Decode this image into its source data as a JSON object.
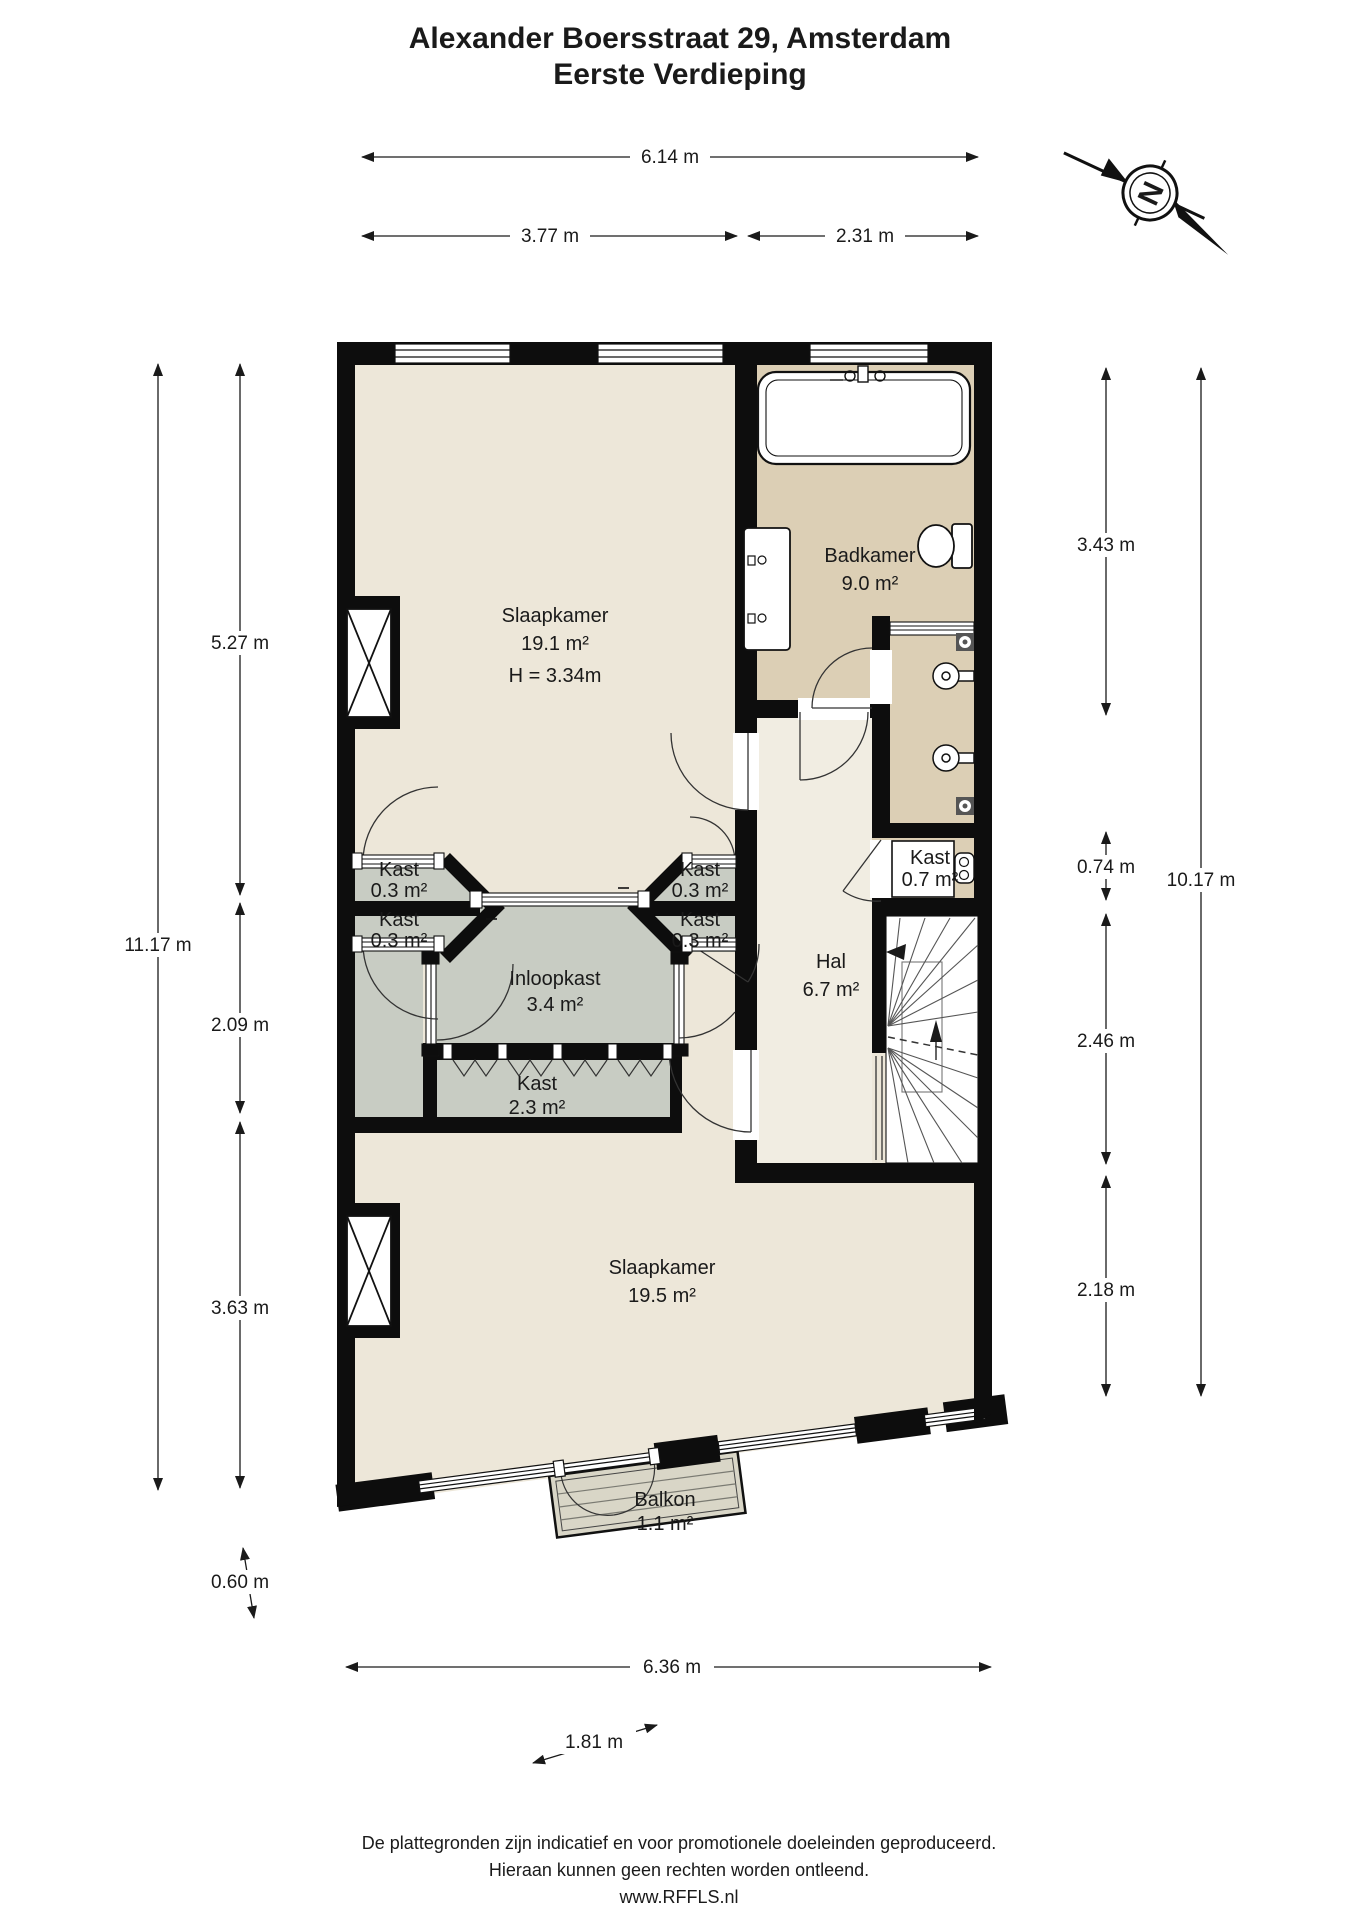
{
  "title": {
    "line1": "Alexander Boersstraat 29, Amsterdam",
    "line2": "Eerste Verdieping"
  },
  "compass": {
    "north": "N"
  },
  "dimensions": {
    "top_total": "6.14 m",
    "top_left": "3.77 m",
    "top_right": "2.31 m",
    "left_total": "11.17 m",
    "left_top": "5.27 m",
    "left_mid": "2.09 m",
    "left_bottom": "3.63 m",
    "balcony_depth": "0.60 m",
    "right_bath": "3.43 m",
    "right_kast": "0.74 m",
    "right_stairs": "2.46 m",
    "right_bed": "2.18 m",
    "right_total": "10.17 m",
    "bottom_total": "6.36 m",
    "balcony_width": "1.81 m"
  },
  "rooms": {
    "slaapkamer1": {
      "name": "Slaapkamer",
      "area": "19.1 m²",
      "height": "H = 3.34m"
    },
    "badkamer": {
      "name": "Badkamer",
      "area": "9.0 m²"
    },
    "kast_lt": {
      "name": "Kast",
      "area": "0.3 m²"
    },
    "kast_lb": {
      "name": "Kast",
      "area": "0.3 m²"
    },
    "kast_rt": {
      "name": "Kast",
      "area": "0.3 m²"
    },
    "kast_rb": {
      "name": "Kast",
      "area": "0.3 m²"
    },
    "inloopkast": {
      "name": "Inloopkast",
      "area": "3.4 m²"
    },
    "kast_groot": {
      "name": "Kast",
      "area": "2.3 m²"
    },
    "kast_cv": {
      "name": "Kast",
      "area": "0.7 m²"
    },
    "hal": {
      "name": "Hal",
      "area": "6.7 m²"
    },
    "slaapkamer2": {
      "name": "Slaapkamer",
      "area": "19.5 m²"
    },
    "balkon": {
      "name": "Balkon",
      "area": "1.1 m²"
    }
  },
  "footer": {
    "line1": "De plattegronden zijn indicatief en voor promotionele doeleinden geproduceerd.",
    "line2": "Hieraan kunnen geen rechten worden ontleend.",
    "line3": "www.RFFLS.nl"
  },
  "colors": {
    "floor_cream": "#EDE7D9",
    "floor_hall": "#F1EDE2",
    "floor_bath": "#DCCFB5",
    "floor_closet": "#C8CCC3",
    "floor_balcony": "#D9D6C7",
    "wall": "#0D0D0D"
  }
}
